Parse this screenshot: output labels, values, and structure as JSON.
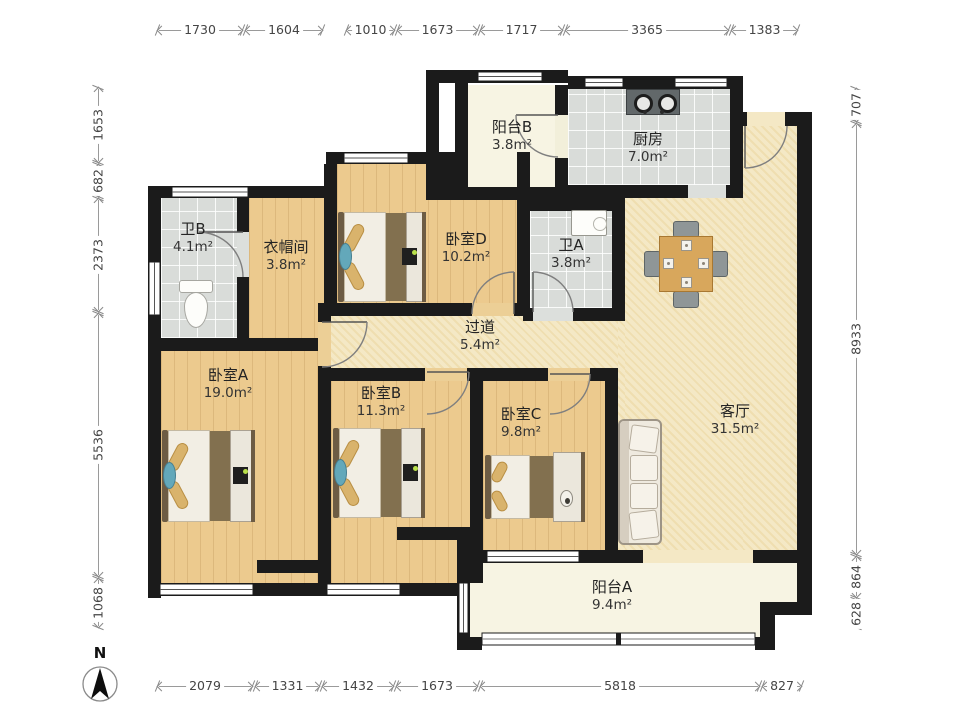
{
  "plan": {
    "rooms": [
      {
        "id": "balcony_b",
        "name": "阳台B",
        "area": "3.8m²"
      },
      {
        "id": "kitchen",
        "name": "厨房",
        "area": "7.0m²"
      },
      {
        "id": "bath_b",
        "name": "卫B",
        "area": "4.1m²"
      },
      {
        "id": "cloakroom",
        "name": "衣帽间",
        "area": "3.8m²"
      },
      {
        "id": "bedroom_d",
        "name": "卧室D",
        "area": "10.2m²"
      },
      {
        "id": "bath_a",
        "name": "卫A",
        "area": "3.8m²"
      },
      {
        "id": "hallway",
        "name": "过道",
        "area": "5.4m²"
      },
      {
        "id": "bedroom_a",
        "name": "卧室A",
        "area": "19.0m²"
      },
      {
        "id": "bedroom_b",
        "name": "卧室B",
        "area": "11.3m²"
      },
      {
        "id": "bedroom_c",
        "name": "卧室C",
        "area": "9.8m²"
      },
      {
        "id": "living_room",
        "name": "客厅",
        "area": "31.5m²"
      },
      {
        "id": "balcony_a",
        "name": "阳台A",
        "area": "9.4m²"
      }
    ],
    "dimensions": {
      "top": [
        "1730",
        "1604",
        "1010",
        "1673",
        "1717",
        "3365",
        "1383"
      ],
      "bottom": [
        "2079",
        "1331",
        "1432",
        "1673",
        "5818",
        "827"
      ],
      "left": [
        "1653",
        "682",
        "2373",
        "5536",
        "1068"
      ],
      "right": [
        "707",
        "8933",
        "864",
        "628"
      ]
    },
    "compass": {
      "label": "N"
    },
    "colors": {
      "wall": "#1b1b1b",
      "wood_floor": "#ecca8e",
      "tile_floor": "#d9dcd9",
      "living_floor": "#f4e8c5",
      "balcony_floor": "#f7f4e3",
      "pillow": "#d9b36c",
      "rug": "#63a8ba"
    }
  }
}
